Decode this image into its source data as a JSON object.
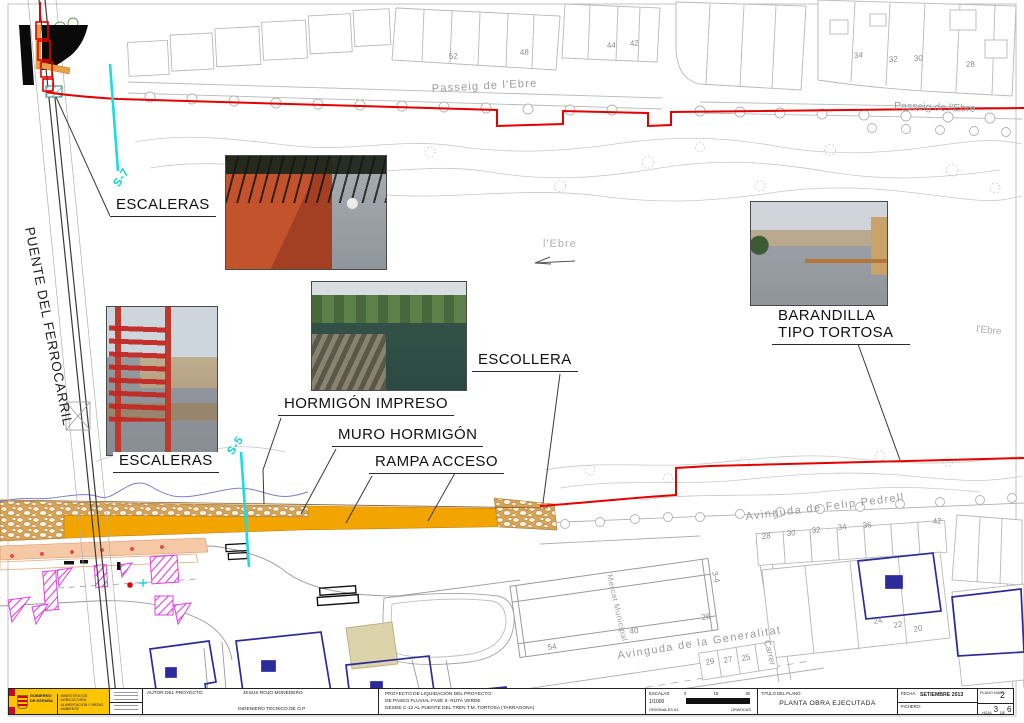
{
  "callouts": {
    "escaleras_top": "ESCALERAS",
    "escaleras_left": "ESCALERAS",
    "hormigon_impreso": "HORMIGÓN IMPRESO",
    "muro_hormigon": "MURO HORMIGÓN",
    "rampa_acceso": "RAMPA ACCESO",
    "escollera": "ESCOLLERA",
    "barandilla_1": "BARANDILLA",
    "barandilla_2": "TIPO TORTOSA",
    "puente": "PUENTE DEL FERROCARRIL",
    "s7": "S-7",
    "s5": "S-5"
  },
  "streets": {
    "passeig_top": "Passeig de l'Ebre",
    "passeig_right": "Passeig de l'Ebre",
    "riu_center": "l'Ebre",
    "riu_right": "l'Ebre",
    "felip_pedrell": "Avinguda de Felip Pedrell",
    "generalitat": "Avinguda de la Generalitat",
    "mercat": "Mercat Municipal",
    "carrer": "Carrer"
  },
  "numbers": {
    "top": [
      "52",
      "48",
      "44",
      "42",
      "34",
      "32",
      "30",
      "28"
    ],
    "pedrell": [
      "28",
      "30",
      "32",
      "34",
      "36",
      "42"
    ],
    "mercat": [
      "54",
      "40",
      "26",
      "3-4"
    ],
    "generalitat": [
      "29",
      "27",
      "25"
    ],
    "right": [
      "24",
      "22",
      "20"
    ]
  },
  "titleblock": {
    "gobierno": "GOBIERNO DE ESPAÑA",
    "ministerio": "MINISTERIO DE AGRICULTURA, ALIMENTACIÓN Y MEDIO AMBIENTE",
    "autor_label": "AUTOR DEL PROYECTO:",
    "autor_name": "JESUS ROJO MONEDERO",
    "autor_title": "INGENIERO TÉCNICO DE O.P.",
    "proyecto_line1": "PROYECTO DE LIQUIDACIÓN DEL PROYECTO:",
    "proyecto_line2": "DE PASEO FLUVIAL FASE II- RUTA VERDE",
    "proyecto_line3": "DESDE C-12 AL PUENTE DEL TREN T.M. TORTOSA (TARRAGONA)",
    "escalas_label": "ESCALAS:",
    "escala_value": "1/1000",
    "originales": "ORIGINALES A3",
    "graficas": "GRAFICAS",
    "ticks": [
      "0",
      "15",
      "30"
    ],
    "titulo_label": "TITULO DEL PLANO:",
    "titulo_value": "PLANTA OBRA EJECUTADA",
    "fecha_label": "FECHA:",
    "fecha_value": "SETIEMBRE 2013",
    "fichero_label": "FICHERO:",
    "plano_label": "PLANO NÚM.",
    "plano_num": "2",
    "hoja_label": "HOJA",
    "hoja_num": "3",
    "de_label": "DE",
    "de_num": "6"
  }
}
